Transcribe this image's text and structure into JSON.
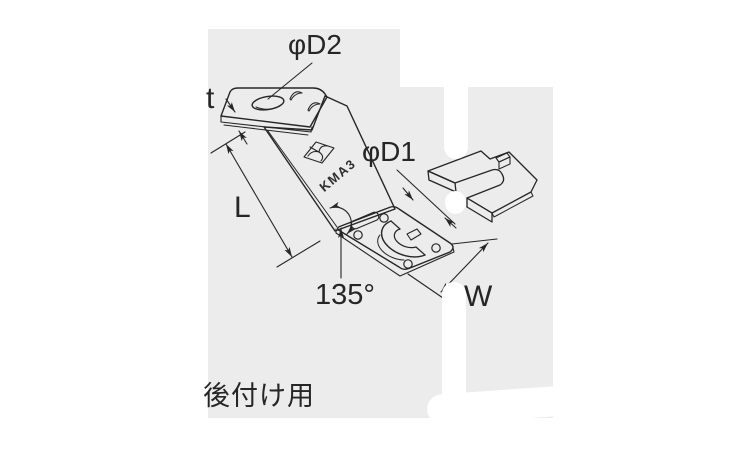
{
  "colors": {
    "background": "#ffffff",
    "panel": "#ececec",
    "ink": "#262626"
  },
  "part": {
    "model_code": "KMA3",
    "caption": "後付け用"
  },
  "dimensions": {
    "thickness": "t",
    "top_hole_diameter": "φD2",
    "base_hole_diameter": "φD1",
    "arm_length": "L",
    "bend_angle": "135°",
    "base_width": "W"
  }
}
